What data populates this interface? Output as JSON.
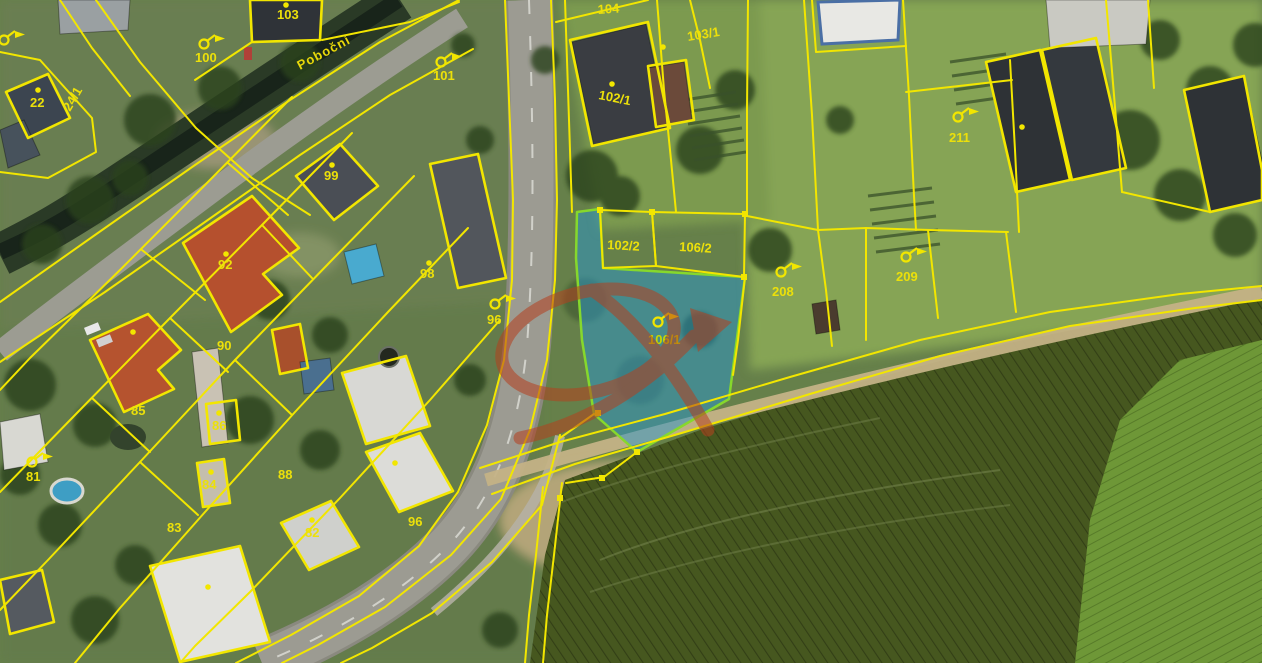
{
  "map": {
    "title": "aerial cadastral map with highlighted parcel",
    "street_label": "Poboční",
    "selected_parcel": {
      "number": "106/1",
      "fill_color": "#2896cd",
      "border_color": "#86d82c"
    },
    "colors": {
      "cadastral_line": "#f2e600",
      "label": "#ece00a",
      "watermark": "#b5401e",
      "selection_fill": "rgba(40,150,205,0.5)"
    },
    "parcel_labels": [
      {
        "text": "104",
        "x": 598,
        "y": 14,
        "rot": -4
      },
      {
        "text": "103/1",
        "x": 688,
        "y": 41,
        "rot": -9
      },
      {
        "text": "102/1",
        "x": 598,
        "y": 99,
        "rot": 11
      },
      {
        "text": "103",
        "x": 277,
        "y": 19,
        "rot": 0
      },
      {
        "text": "100",
        "x": 195,
        "y": 62,
        "rot": 0
      },
      {
        "text": "101",
        "x": 433,
        "y": 80,
        "rot": 0
      },
      {
        "text": "24/1",
        "x": 70,
        "y": 112,
        "rot": -60
      },
      {
        "text": "22",
        "x": 30,
        "y": 107,
        "rot": 0
      },
      {
        "text": "99",
        "x": 324,
        "y": 180,
        "rot": 0
      },
      {
        "text": "92",
        "x": 218,
        "y": 269,
        "rot": 0
      },
      {
        "text": "90",
        "x": 217,
        "y": 350,
        "rot": 0
      },
      {
        "text": "98",
        "x": 420,
        "y": 278,
        "rot": 0
      },
      {
        "text": "96",
        "x": 487,
        "y": 324,
        "rot": 0
      },
      {
        "text": "85",
        "x": 131,
        "y": 415,
        "rot": 0
      },
      {
        "text": "81",
        "x": 26,
        "y": 481,
        "rot": 0
      },
      {
        "text": "86",
        "x": 212,
        "y": 430,
        "rot": 0
      },
      {
        "text": "84",
        "x": 202,
        "y": 489,
        "rot": 0
      },
      {
        "text": "83",
        "x": 167,
        "y": 532,
        "rot": 0
      },
      {
        "text": "88",
        "x": 278,
        "y": 479,
        "rot": 0
      },
      {
        "text": "82",
        "x": 305,
        "y": 537,
        "rot": 0
      },
      {
        "text": "96",
        "x": 408,
        "y": 526,
        "rot": 0
      },
      {
        "text": "102/2",
        "x": 607,
        "y": 249,
        "rot": 3
      },
      {
        "text": "106/2",
        "x": 679,
        "y": 251,
        "rot": 3
      },
      {
        "text": "106/1",
        "x": 648,
        "y": 344,
        "rot": 0,
        "cls": "selected"
      },
      {
        "text": "208",
        "x": 772,
        "y": 296,
        "rot": 0
      },
      {
        "text": "209",
        "x": 896,
        "y": 281,
        "rot": 0
      },
      {
        "text": "211",
        "x": 949,
        "y": 142,
        "rot": 0
      },
      {
        "text": "Poboční",
        "x": 300,
        "y": 70,
        "rot": -28,
        "cls": "street"
      }
    ],
    "parcel_symbols": [
      {
        "x": 204,
        "y": 44
      },
      {
        "x": 441,
        "y": 62
      },
      {
        "x": 495,
        "y": 304
      },
      {
        "x": 32,
        "y": 462
      },
      {
        "x": 4,
        "y": 40
      },
      {
        "x": 781,
        "y": 272
      },
      {
        "x": 906,
        "y": 257
      },
      {
        "x": 958,
        "y": 117
      },
      {
        "x": 658,
        "y": 322,
        "cls": "green"
      }
    ],
    "building_dots": [
      {
        "x": 38,
        "y": 90
      },
      {
        "x": 286,
        "y": 5
      },
      {
        "x": 612,
        "y": 84
      },
      {
        "x": 663,
        "y": 47
      },
      {
        "x": 332,
        "y": 165
      },
      {
        "x": 226,
        "y": 254
      },
      {
        "x": 133,
        "y": 332
      },
      {
        "x": 219,
        "y": 413
      },
      {
        "x": 211,
        "y": 472
      },
      {
        "x": 312,
        "y": 520
      },
      {
        "x": 395,
        "y": 463
      },
      {
        "x": 208,
        "y": 587
      },
      {
        "x": 429,
        "y": 263
      },
      {
        "x": 1022,
        "y": 127
      }
    ],
    "boundary_nodes": [
      {
        "x": 600,
        "y": 210
      },
      {
        "x": 652,
        "y": 212
      },
      {
        "x": 745,
        "y": 214
      },
      {
        "x": 744,
        "y": 277
      },
      {
        "x": 637,
        "y": 452
      },
      {
        "x": 598,
        "y": 413
      },
      {
        "x": 602,
        "y": 478
      },
      {
        "x": 560,
        "y": 498
      }
    ]
  }
}
